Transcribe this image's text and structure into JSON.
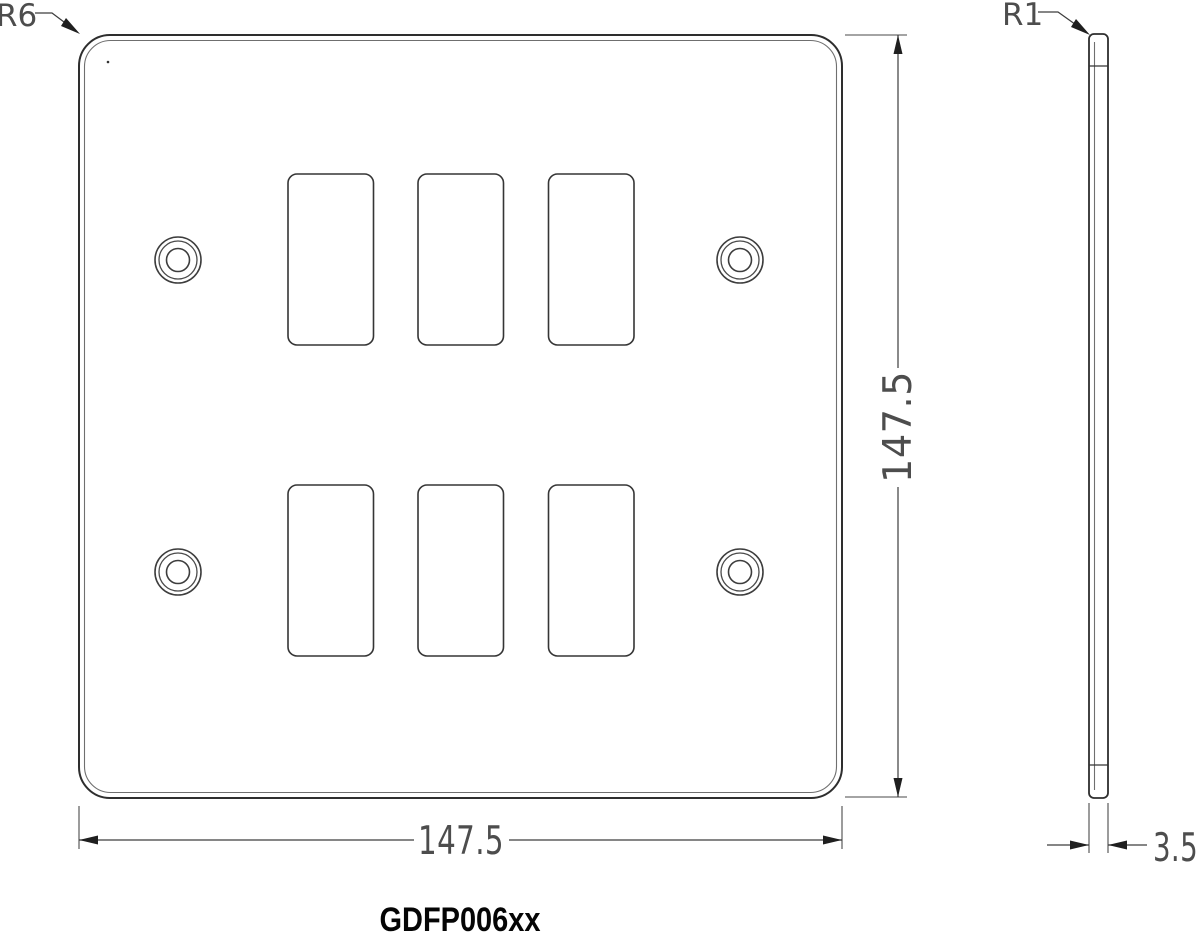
{
  "drawing": {
    "part_number": "GDFP006xx",
    "views": {
      "front": {
        "name": "faceplate-front-view",
        "width_label": "147.5",
        "height_label": "147.5",
        "corner_radius_label": "R6",
        "cutout_count": 6,
        "screw_hole_count": 4
      },
      "side": {
        "name": "faceplate-side-view",
        "thickness_label": "3.5",
        "edge_radius_label": "R1"
      }
    },
    "colors": {
      "line": "#2e2e2e",
      "dimension_text": "#4d4d4d",
      "part_number_text": "#050505",
      "background": "#ffffff"
    }
  }
}
